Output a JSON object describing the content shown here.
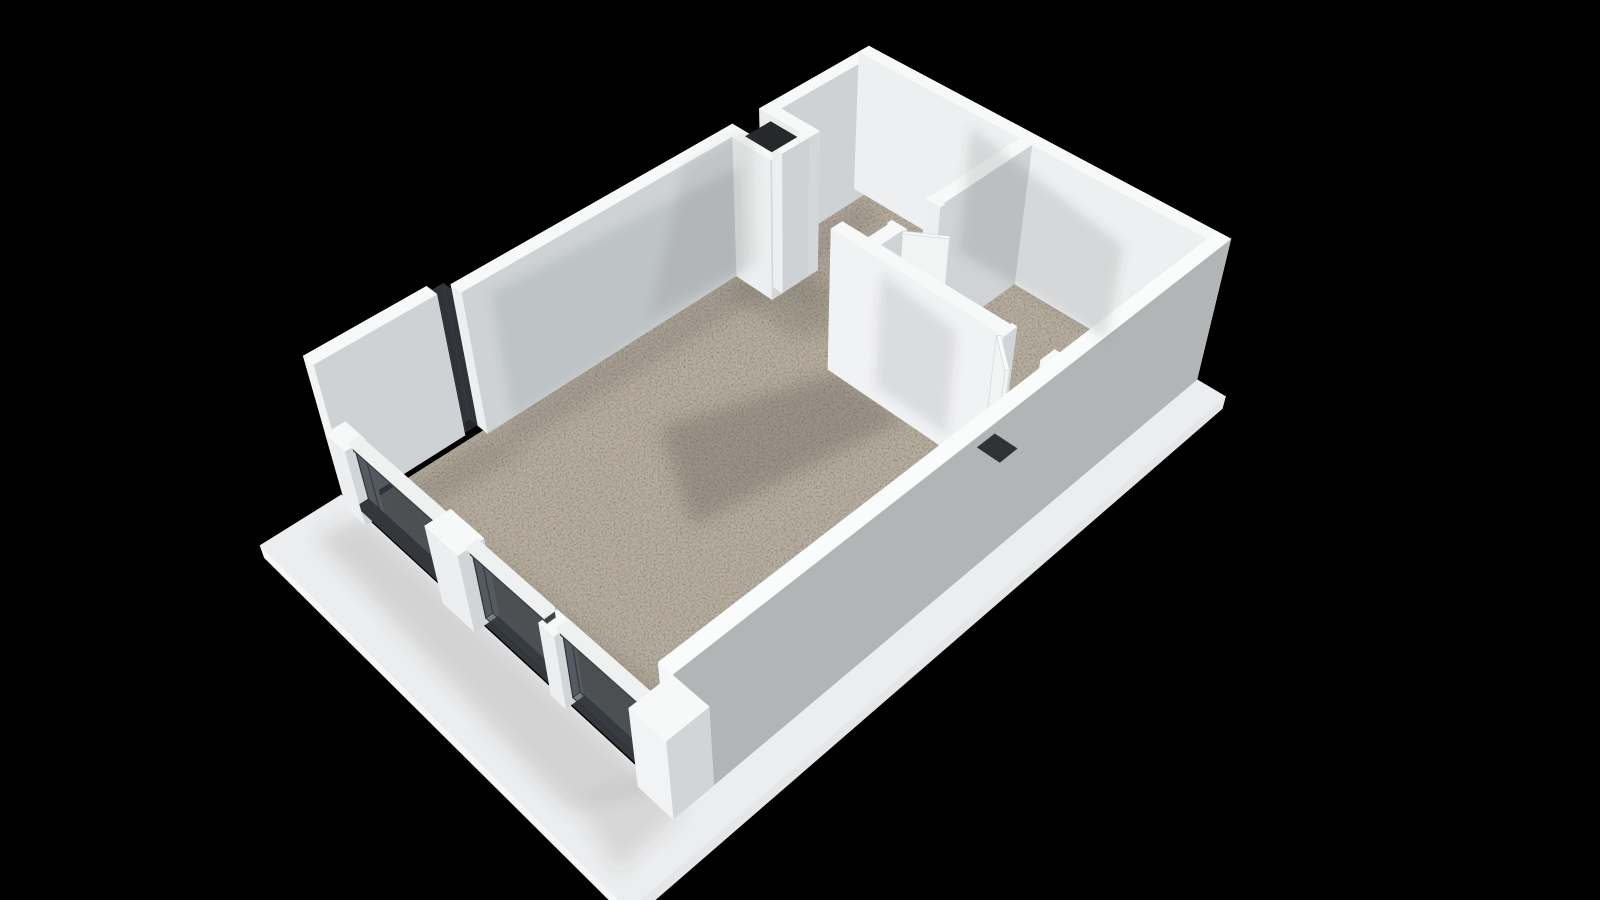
{
  "meta": {
    "title": "3D floor plan render — one-bedroom apartment, isometric view",
    "background": "#000000",
    "render_style": "white walls, sand-speckled floor, glazed terrace facade"
  },
  "colors": {
    "background": "#000000",
    "floor": "#b9b0a2",
    "floor_edge": "#cfc8bb",
    "slab_top": "#ebedee",
    "slab_side": "#f6f7f8",
    "wall_top": "#f7f8f8",
    "wall_bright": "#f1f2f3",
    "wall_mid": "#eceeef",
    "wall_shade": "#ced2d4",
    "wall_dark_outer": "#b2b5b6",
    "glass": "rgba(58,64,70,0.58)",
    "glass_frame": "#2e3338",
    "rail_dark": "#3f4449",
    "hole_dark": "#26282a",
    "shadow": "#56514a",
    "wall_shadow": "#4a4f53",
    "door_face": "#f2f4f4",
    "handle": "#5f6468"
  },
  "camera": {
    "target": [
      350,
      225,
      40
    ],
    "distance": 1650,
    "focal": 1650,
    "center": [
      790,
      412
    ],
    "right": [
      0.707,
      0.707,
      0
    ],
    "up": [
      0.5,
      -0.5,
      0.707
    ],
    "forward": [
      0.5,
      -0.5,
      -0.707
    ]
  },
  "rooms": [
    {
      "name": "living-room"
    },
    {
      "name": "hallway"
    },
    {
      "name": "bedroom"
    },
    {
      "name": "terrace"
    }
  ],
  "scene": {
    "floor": {
      "name": "apartment-floor",
      "rect": [
        -6,
        -6,
        710,
        460
      ],
      "z": -8,
      "h": 8
    },
    "slab": {
      "name": "terrace-slab",
      "points": [
        [
          -108,
          -34
        ],
        [
          -16,
          -34
        ],
        [
          -16,
          466
        ],
        [
          716,
          466
        ],
        [
          716,
          502
        ],
        [
          -108,
          502
        ]
      ],
      "z": -18,
      "h": 18
    },
    "walls": [
      {
        "name": "wall-nw-west-segment",
        "rect": [
          -16,
          -30,
          136,
          16
        ],
        "z": 0,
        "h": 190,
        "pal": {
          "py": "#ced2d4",
          "mx": "#f2f3f3",
          "px": "#e8eaeb",
          "my": "#e6e8e9"
        }
      },
      {
        "name": "wall-nw-main-a",
        "rect": [
          138,
          -16,
          351,
          16
        ],
        "z": 0,
        "h": 190,
        "pal": {
          "py": "#ced2d4",
          "my": "#e8e9ea"
        }
      },
      {
        "name": "shaft-jamb-west",
        "rect": [
          489,
          -16,
          16,
          74
        ],
        "z": 0,
        "h": 190,
        "pal": {
          "py": "#d4d7d9",
          "px": "#dde0e1"
        }
      },
      {
        "name": "shaft-jamb-east",
        "rect": [
          545,
          -16,
          16,
          74
        ],
        "z": 0,
        "h": 190,
        "pal": {
          "py": "#d4d7d9",
          "mx": "#e9ebec"
        }
      },
      {
        "name": "shaft-front",
        "rect": [
          505,
          44,
          40,
          14
        ],
        "z": 0,
        "h": 190,
        "pal": {
          "py": "#ced2d4"
        }
      },
      {
        "name": "wall-nw-main-b",
        "rect": [
          561,
          -16,
          155,
          16
        ],
        "z": 0,
        "h": 190,
        "pal": {
          "py": "#ced2d4",
          "my": "#e8e9ea"
        }
      },
      {
        "name": "wall-ne",
        "rect": [
          700,
          -16,
          16,
          482
        ],
        "z": 0,
        "h": 190,
        "pal": {
          "mx": "#edeff0",
          "px": "#e9ebec",
          "my": "#f0f1f2"
        }
      },
      {
        "name": "wall-se",
        "rect": [
          -16,
          450,
          732,
          16
        ],
        "z": 0,
        "h": 190,
        "pal": {
          "my": "#f3f4f4",
          "py": "#b2b5b6",
          "mx": "#f5f6f6",
          "top": "#fafbfb"
        }
      },
      {
        "name": "wall-partition-long",
        "rect": [
          452,
          180,
          16,
          214
        ],
        "z": 0,
        "h": 190,
        "pal": {
          "mx": "#f1f2f3",
          "px": "#d4d7d9",
          "my": "#eceeef"
        }
      },
      {
        "name": "door-frame-living-a",
        "rect": [
          450,
          394,
          20,
          6
        ],
        "z": 0,
        "h": 190,
        "pal": {
          "mx": "#f4f5f6",
          "px": "#e6e8e9"
        }
      },
      {
        "name": "door-frame-living-b",
        "rect": [
          450,
          444,
          20,
          6
        ],
        "z": 0,
        "h": 190,
        "pal": {
          "mx": "#f4f5f6",
          "px": "#e6e8e9"
        }
      },
      {
        "name": "wall-partition-cross-a",
        "rect": [
          462,
          215,
          38,
          16
        ],
        "z": 0,
        "h": 190,
        "pal": {
          "my": "#e9ebec",
          "py": "#cfd3d5"
        }
      },
      {
        "name": "door-frame-hall-a",
        "rect": [
          498,
          213,
          6,
          20
        ],
        "z": 0,
        "h": 190,
        "pal": {
          "my": "#f3f4f5"
        }
      },
      {
        "name": "door-frame-hall-b",
        "rect": [
          554,
          213,
          6,
          20
        ],
        "z": 0,
        "h": 190,
        "pal": {
          "my": "#f3f4f5"
        }
      },
      {
        "name": "wall-partition-cross-b",
        "rect": [
          560,
          215,
          140,
          16
        ],
        "z": 0,
        "h": 190,
        "pal": {
          "my": "#e9ebec",
          "py": "#cfd3d5"
        }
      },
      {
        "name": "duct-column",
        "rect": [
          400,
          404,
          46,
          46
        ],
        "z": 0,
        "h": 88,
        "pal": {
          "my": "#f0f2f2",
          "mx": "#eef0f0"
        }
      },
      {
        "name": "pillar-south",
        "rect": [
          -28,
          422,
          46,
          44
        ],
        "z": 0,
        "h": 114,
        "pal": {
          "my": "#f4f5f5",
          "mx": "#f2f3f4"
        }
      },
      {
        "name": "facade-post-west",
        "rect": [
          -22,
          -16,
          22,
          32
        ],
        "z": 0,
        "h": 104,
        "pal": {}
      },
      {
        "name": "facade-doorframe-block",
        "rect": [
          -26,
          146,
          28,
          48
        ],
        "z": 0,
        "h": 108,
        "pal": {}
      },
      {
        "name": "facade-post-mid",
        "rect": [
          -21,
          298,
          20,
          20
        ],
        "z": 0,
        "h": 104,
        "pal": {}
      }
    ],
    "glass": [
      {
        "name": "glass-notch-tall",
        "rect": [
          122,
          -26,
          14,
          12
        ],
        "z": 4,
        "h": 182
      },
      {
        "name": "glass-panel-1",
        "rect": [
          -12,
          16,
          8,
          128
        ],
        "z": 8,
        "h": 88
      },
      {
        "name": "glass-panel-2",
        "rect": [
          -12,
          194,
          8,
          102
        ],
        "z": 8,
        "h": 88
      },
      {
        "name": "glass-panel-3",
        "rect": [
          -12,
          318,
          8,
          104
        ],
        "z": 8,
        "h": 88
      }
    ],
    "rails": [
      {
        "name": "facade-base-rail",
        "rect": [
          -14,
          -2,
          10,
          456
        ],
        "z": 0,
        "h": 10,
        "color": "#34383c"
      },
      {
        "name": "glass-top-rail-1",
        "rect": [
          -13,
          14,
          9,
          132
        ],
        "z": 96,
        "h": 8,
        "color": "#3f4449"
      },
      {
        "name": "glass-top-rail-2",
        "rect": [
          -13,
          192,
          9,
          106
        ],
        "z": 96,
        "h": 8,
        "color": "#3f4449"
      },
      {
        "name": "glass-top-rail-3",
        "rect": [
          -13,
          316,
          9,
          108
        ],
        "z": 96,
        "h": 8,
        "color": "#3f4449"
      },
      {
        "name": "glass-cap-1",
        "rect": [
          -15,
          14,
          12,
          132
        ],
        "z": 104,
        "h": 5,
        "color": "#eff1f1"
      },
      {
        "name": "glass-cap-2",
        "rect": [
          -15,
          192,
          12,
          106
        ],
        "z": 104,
        "h": 5,
        "color": "#eff1f1"
      },
      {
        "name": "glass-cap-3",
        "rect": [
          -15,
          316,
          12,
          108
        ],
        "z": 104,
        "h": 5,
        "color": "#eff1f1"
      }
    ],
    "doors": [
      {
        "name": "door-leaf-living",
        "points": [
          [
            452,
            396
          ],
          [
            422,
            431
          ],
          [
            419,
            428.4
          ],
          [
            449,
            393.4
          ]
        ],
        "z": 2,
        "h": 186
      },
      {
        "name": "door-leaf-hall",
        "points": [
          [
            500,
            229
          ],
          [
            527.5,
            268.3
          ],
          [
            524.2,
            270.6
          ],
          [
            496.7,
            231.3
          ]
        ],
        "z": 2,
        "h": 186
      }
    ],
    "handles": [
      {
        "name": "door-handle-living",
        "points": [
          [
            426,
            425
          ],
          [
            430,
            427
          ],
          [
            428.8,
            429.3
          ],
          [
            424.8,
            427.3
          ]
        ],
        "z": 86,
        "h": 12
      },
      {
        "name": "door-handle-hall",
        "points": [
          [
            519,
            258
          ],
          [
            523.5,
            261
          ],
          [
            522,
            263.4
          ],
          [
            517.5,
            260.4
          ]
        ],
        "z": 86,
        "h": 12
      }
    ],
    "holes": [
      {
        "name": "shaft-opening",
        "rect": [
          506,
          2,
          38,
          40
        ],
        "z": 183,
        "color": "#26282a"
      },
      {
        "name": "duct-opening",
        "rect": [
          410,
          414,
          26,
          28
        ],
        "z": 84,
        "color": "#303234"
      }
    ],
    "floor_shadows": [
      {
        "name": "shadow-living-center",
        "points": [
          [
            455,
            190
          ],
          [
            455,
            288
          ],
          [
            200,
            240
          ],
          [
            268,
            118
          ]
        ],
        "o": 0.3
      },
      {
        "name": "shadow-nw-band",
        "points": [
          [
            140,
            2
          ],
          [
            698,
            2
          ],
          [
            676,
            54
          ],
          [
            152,
            38
          ]
        ],
        "o": 0.2
      },
      {
        "name": "shadow-hall-west",
        "points": [
          [
            462,
            4
          ],
          [
            556,
            28
          ],
          [
            514,
            152
          ],
          [
            462,
            122
          ]
        ],
        "o": 0.22
      },
      {
        "name": "shadow-hall-shaft",
        "points": [
          [
            505,
            58
          ],
          [
            561,
            58
          ],
          [
            586,
            124
          ],
          [
            516,
            104
          ]
        ],
        "o": 0.18
      },
      {
        "name": "shadow-bedroom",
        "points": [
          [
            470,
            233
          ],
          [
            648,
            233
          ],
          [
            560,
            324
          ],
          [
            470,
            312
          ]
        ],
        "o": 0.24
      },
      {
        "name": "shadow-se-band",
        "points": [
          [
            28,
            382
          ],
          [
            452,
            406
          ],
          [
            452,
            448
          ],
          [
            16,
            448
          ]
        ],
        "o": 0.2
      },
      {
        "name": "shadow-facade-strip",
        "points": [
          [
            2,
            44
          ],
          [
            40,
            64
          ],
          [
            56,
            432
          ],
          [
            2,
            420
          ]
        ],
        "o": 0.18
      },
      {
        "name": "shadow-west-block",
        "points": [
          [
            2,
            2
          ],
          [
            132,
            2
          ],
          [
            152,
            50
          ],
          [
            8,
            42
          ]
        ],
        "o": 0.22
      },
      {
        "name": "shadow-hall-door",
        "points": [
          [
            470,
            180
          ],
          [
            560,
            206
          ],
          [
            470,
            215
          ]
        ],
        "o": 0.2
      }
    ],
    "slab_shadows": [
      {
        "name": "shadow-terrace-a",
        "points": [
          [
            -64,
            -4
          ],
          [
            -16,
            6
          ],
          [
            -16,
            436
          ],
          [
            -84,
            396
          ]
        ],
        "o": 0.16
      },
      {
        "name": "shadow-terrace-b",
        "points": [
          [
            -76,
            396
          ],
          [
            -16,
            420
          ],
          [
            -16,
            466
          ],
          [
            -92,
            470
          ]
        ],
        "o": 0.13
      }
    ],
    "face_shadows": [
      {
        "name": "shadow-ne-wall",
        "points": [
          [
            699,
            150,
            0
          ],
          [
            699,
            360,
            0
          ],
          [
            699,
            360,
            130
          ],
          [
            699,
            150,
            172
          ]
        ],
        "o": 0.15
      },
      {
        "name": "shadow-nw-wall",
        "points": [
          [
            170,
            1,
            0
          ],
          [
            500,
            1,
            0
          ],
          [
            500,
            1,
            148
          ],
          [
            170,
            1,
            170
          ]
        ],
        "o": 0.12
      },
      {
        "name": "shadow-nw-wall-2",
        "points": [
          [
            360,
            1,
            20
          ],
          [
            520,
            1,
            0
          ],
          [
            520,
            1,
            188
          ],
          [
            420,
            1,
            188
          ]
        ],
        "o": 0.1
      },
      {
        "name": "shadow-partition-bedroom",
        "points": [
          [
            469,
            233,
            0
          ],
          [
            469,
            332,
            0
          ],
          [
            469,
            332,
            140
          ],
          [
            469,
            233,
            155
          ]
        ],
        "o": 0.13
      }
    ]
  }
}
